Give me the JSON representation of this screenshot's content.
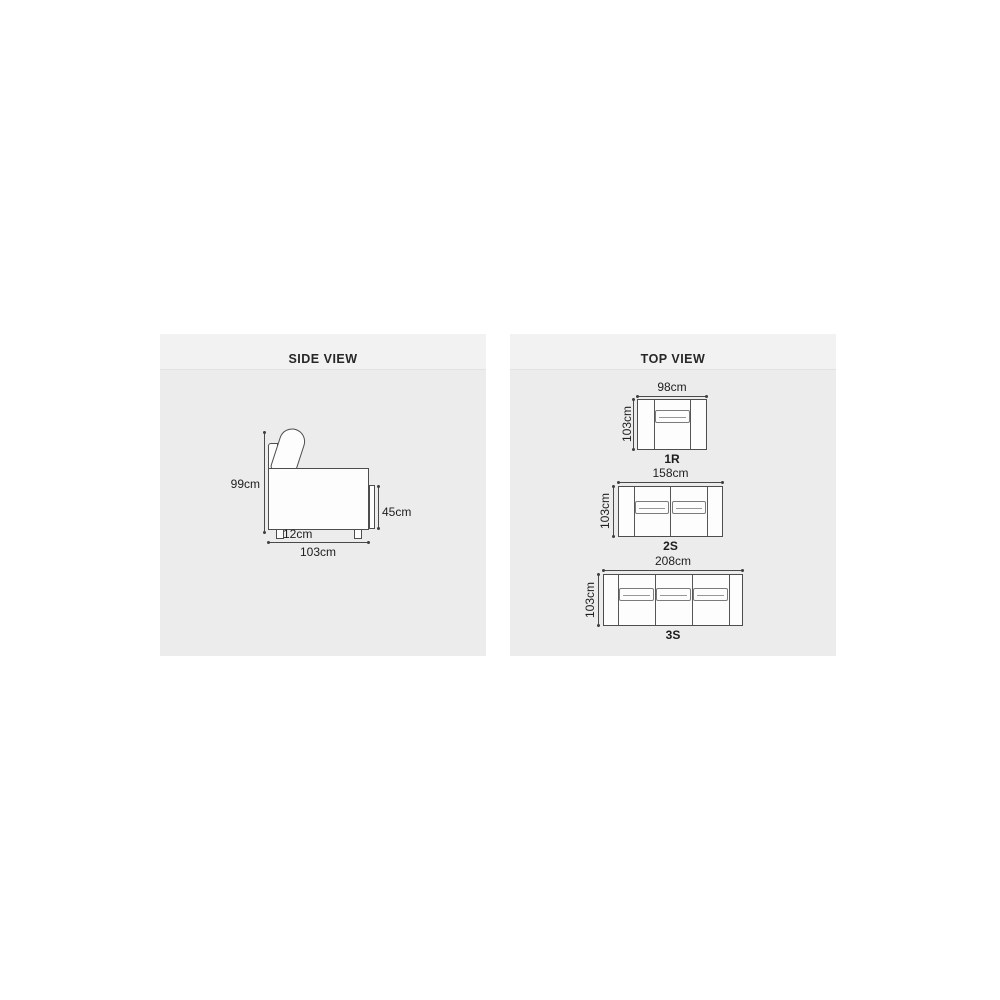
{
  "side_view": {
    "title": "SIDE VIEW",
    "dimensions": {
      "height": "99cm",
      "width": "103cm",
      "seat_height": "45cm",
      "leg_height": "12cm"
    }
  },
  "top_view": {
    "title": "TOP VIEW",
    "variants": [
      {
        "label": "1R",
        "width": "98cm",
        "depth": "103cm"
      },
      {
        "label": "2S",
        "width": "158cm",
        "depth": "103cm"
      },
      {
        "label": "3S",
        "width": "208cm",
        "depth": "103cm"
      }
    ]
  },
  "colors": {
    "page_background": "#ffffff",
    "panel_background": "#ececec",
    "panel_strip": "#f2f2f2",
    "line": "#4d4d4d",
    "text": "#1e1e1e"
  }
}
